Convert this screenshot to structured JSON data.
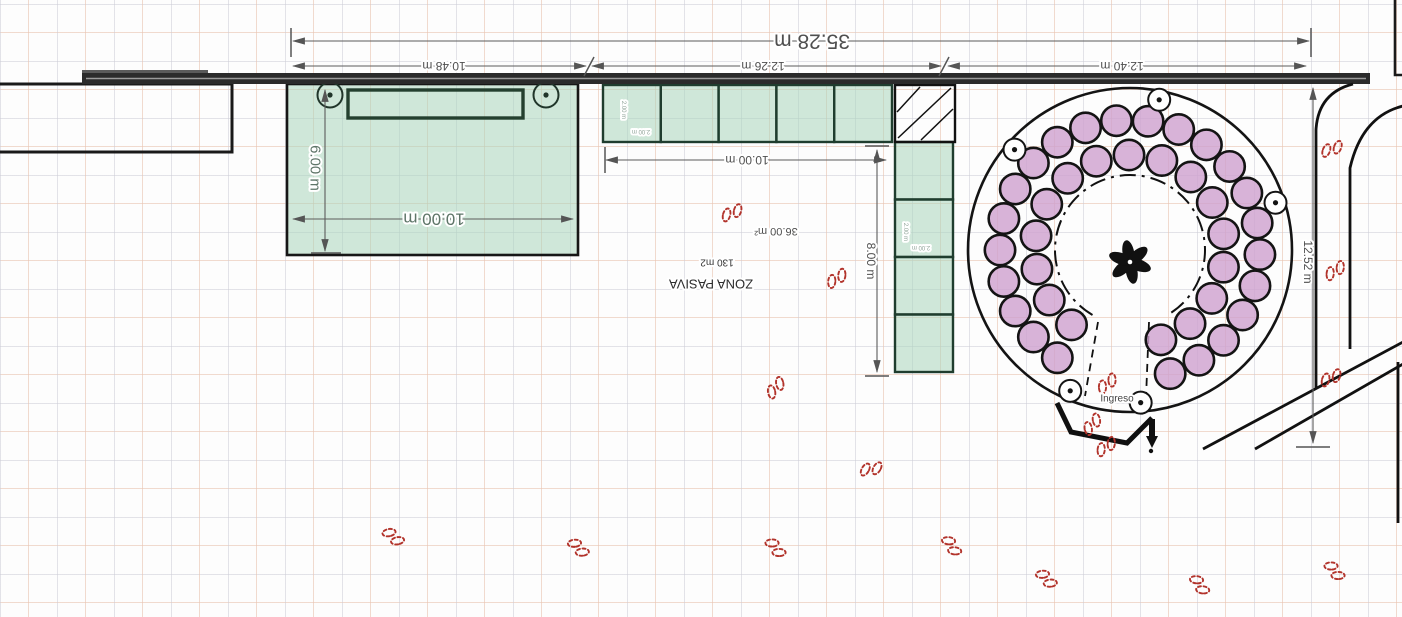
{
  "meta": {
    "view": "site-plan",
    "canvas": {
      "w": 1402,
      "h": 617
    }
  },
  "colors": {
    "wall": "#1a1a1a",
    "bar_fill": "#2b2b2b",
    "bar_stripe": "#9a9a9a",
    "green_fill": "rgba(170,214,188,0.55)",
    "green_stroke": "#1f3d2e",
    "purple_fill": "rgba(206,160,206,0.8)",
    "purple_stroke": "#141414",
    "dim_line": "#5c5c5c",
    "dim_text": "#4f4f4f",
    "green_text": "#5e7568",
    "tiny_text": "#8fa398",
    "red": "#b2332b"
  },
  "plan": {
    "left_room": {
      "x": -4,
      "y": 84,
      "w": 236,
      "h": 68
    },
    "boardwalk": {
      "x": 82,
      "y": 73,
      "w": 1288,
      "h": 11
    },
    "boardwalk_step": {
      "x": 82,
      "y": 70,
      "w": 126,
      "h": 4
    },
    "corner_path": "M1395,0 L1395,75 L1403,75",
    "roads": [
      "M1353,84 Q1318,93 1316,130 L1316,388",
      "M1403,106 Q1362,116 1350,168 L1350,349",
      "M1203,449 L1403,342",
      "M1255,449 L1403,364",
      "M1398,362 L1398,523"
    ],
    "green_box": {
      "x": 287,
      "y": 84,
      "w": 291,
      "h": 171
    },
    "stage": {
      "x": 348,
      "y": 90,
      "w": 175,
      "h": 28
    },
    "speakers": [
      [
        330,
        95
      ],
      [
        546,
        95
      ]
    ],
    "hcells": {
      "x": 603,
      "y": 85,
      "w": 57.8,
      "h": 57,
      "n": 5
    },
    "vcells": {
      "x": 895,
      "y": 142,
      "w": 58,
      "h": 57.5,
      "n": 4
    },
    "hatch": {
      "x": 895,
      "y": 85,
      "w": 60,
      "h": 57,
      "lines": [
        "M898,138 L951,88",
        "M897,112 L920,87",
        "M921,140 L953,109"
      ]
    },
    "plaza": {
      "cx": 1130,
      "cy": 250,
      "r": 162,
      "inner_r": 75,
      "rings": [
        {
          "r": 130,
          "cr": 15.2,
          "a0": 124,
          "a1": 432,
          "n": 23
        },
        {
          "r": 95,
          "cr": 15.2,
          "a0": 128,
          "a1": 431,
          "n": 16
        }
      ],
      "lamps": {
        "r": 153,
        "cr": 11,
        "angles": [
          281,
          221,
          342,
          113,
          86
        ]
      },
      "palm": {
        "cx": 1130,
        "cy": 262,
        "petals": 6,
        "len": 12.5,
        "wid": 5.8,
        "off": 9.5
      }
    },
    "corridor": [
      "M1098,322 L1085,396",
      "M1149,322 L1146,398"
    ],
    "entrance": {
      "path": "M1057,403 L1071,432 L1127,443 L1152,418",
      "bar": "M1152,419 L1152,437",
      "arrow": "M1146,436 L1158,436 L1152,448 Z",
      "dot": [
        1151,
        451
      ]
    },
    "dim_lines": [
      {
        "x1": 293,
        "y1": 41,
        "x2": 1309,
        "y2": 41
      },
      {
        "x1": 293,
        "y1": 66,
        "x2": 586,
        "y2": 66
      },
      {
        "x1": 592,
        "y1": 66,
        "x2": 941,
        "y2": 66
      },
      {
        "x1": 948,
        "y1": 66,
        "x2": 1306,
        "y2": 66
      },
      {
        "x1": 1313,
        "y1": 88,
        "x2": 1313,
        "y2": 443
      },
      {
        "x1": 325,
        "y1": 90,
        "x2": 325,
        "y2": 251
      },
      {
        "x1": 293,
        "y1": 219,
        "x2": 573,
        "y2": 219
      },
      {
        "x1": 606,
        "y1": 160,
        "x2": 886,
        "y2": 160
      },
      {
        "x1": 877,
        "y1": 150,
        "x2": 877,
        "y2": 372
      }
    ],
    "ticks": [
      {
        "x1": 291,
        "y1": 28,
        "x2": 291,
        "y2": 57
      },
      {
        "x1": 1311,
        "y1": 28,
        "x2": 1311,
        "y2": 57
      },
      {
        "x1": 584,
        "y1": 76,
        "x2": 594,
        "y2": 57
      },
      {
        "x1": 939,
        "y1": 76,
        "x2": 949,
        "y2": 57
      },
      {
        "x1": 1296,
        "y1": 447,
        "x2": 1330,
        "y2": 447
      },
      {
        "x1": 311,
        "y1": 253,
        "x2": 341,
        "y2": 253
      },
      {
        "x1": 605,
        "y1": 147,
        "x2": 605,
        "y2": 173
      },
      {
        "x1": 865,
        "y1": 146,
        "x2": 889,
        "y2": 146
      },
      {
        "x1": 865,
        "y1": 376,
        "x2": 889,
        "y2": 376
      }
    ],
    "texts": [
      {
        "name": "dim-35-28",
        "t": "35.28 m",
        "x": 812,
        "y": 41,
        "rot": 180,
        "size": 21,
        "color": "#4f4f4f"
      },
      {
        "name": "dim-10-48",
        "t": "10.48 m",
        "x": 444,
        "y": 66,
        "rot": 180,
        "size": 12,
        "color": "#4f4f4f"
      },
      {
        "name": "dim-12-26",
        "t": "12.26 m",
        "x": 763,
        "y": 66,
        "rot": 180,
        "size": 12,
        "color": "#4f4f4f"
      },
      {
        "name": "dim-12-40",
        "t": "12.40 m",
        "x": 1122,
        "y": 66,
        "rot": 180,
        "size": 12,
        "color": "#4f4f4f"
      },
      {
        "name": "dim-12-52",
        "t": "12.52 m",
        "x": 1308,
        "y": 262,
        "rot": 90,
        "size": 12,
        "color": "#4f4f4f"
      },
      {
        "name": "dim-6-00",
        "t": "6.00 m",
        "x": 315,
        "y": 168,
        "rot": 90,
        "size": 15,
        "color": "#5e7568"
      },
      {
        "name": "dim-10-00-left",
        "t": "10.00 m",
        "x": 434,
        "y": 219,
        "rot": 180,
        "size": 17,
        "color": "#5e7568"
      },
      {
        "name": "dim-10-00-mid",
        "t": "10.00 m",
        "x": 747,
        "y": 160,
        "rot": 180,
        "size": 12,
        "color": "#4f4f4f"
      },
      {
        "name": "dim-8-00",
        "t": "8.00 m",
        "x": 871,
        "y": 261,
        "rot": 90,
        "size": 12,
        "color": "#4f4f4f"
      },
      {
        "name": "area-36-00",
        "t": "36.00 m²",
        "x": 776,
        "y": 231,
        "rot": 180,
        "size": 11,
        "color": "#4f4f4f"
      },
      {
        "name": "area-130",
        "t": "130 m2",
        "x": 717,
        "y": 262,
        "rot": 180,
        "size": 10,
        "color": "#333333"
      },
      {
        "name": "zona-pasiva",
        "t": "ZONA PASIVA",
        "x": 711,
        "y": 284,
        "rot": 180,
        "size": 13,
        "color": "#2d2d2d"
      },
      {
        "name": "ingreso",
        "t": "Ingreso",
        "x": 1117,
        "y": 399,
        "rot": 0,
        "size": 10,
        "color": "#444444"
      },
      {
        "name": "cell-2m-v1",
        "t": "2.00 m",
        "x": 623,
        "y": 110,
        "rot": 90,
        "size": 6,
        "color": "#8fa398"
      },
      {
        "name": "cell-2m-h1",
        "t": "2.00 m",
        "x": 641,
        "y": 131,
        "rot": 180,
        "size": 6,
        "color": "#8fa398"
      },
      {
        "name": "cell-2m-v2",
        "t": "2.00 m",
        "x": 905,
        "y": 232,
        "rot": 90,
        "size": 6,
        "color": "#8fa398"
      },
      {
        "name": "cell-2m-h2",
        "t": "2.00 m",
        "x": 921,
        "y": 247,
        "rot": 180,
        "size": 6,
        "color": "#8fa398"
      }
    ],
    "footprints": [
      [
        731,
        212,
        195
      ],
      [
        838,
        279,
        5
      ],
      [
        777,
        388,
        350
      ],
      [
        872,
        470,
        30
      ],
      [
        393,
        538,
        80
      ],
      [
        578,
        549,
        85
      ],
      [
        775,
        549,
        90
      ],
      [
        951,
        547,
        95
      ],
      [
        1046,
        580,
        85
      ],
      [
        1199,
        586,
        95
      ],
      [
        1334,
        572,
        90
      ],
      [
        1331,
        148,
        200
      ],
      [
        1334,
        270,
        185
      ],
      [
        1330,
        377,
        195
      ],
      [
        1106,
        383,
        180
      ],
      [
        1091,
        424,
        170
      ],
      [
        1105,
        446,
        185
      ]
    ]
  }
}
